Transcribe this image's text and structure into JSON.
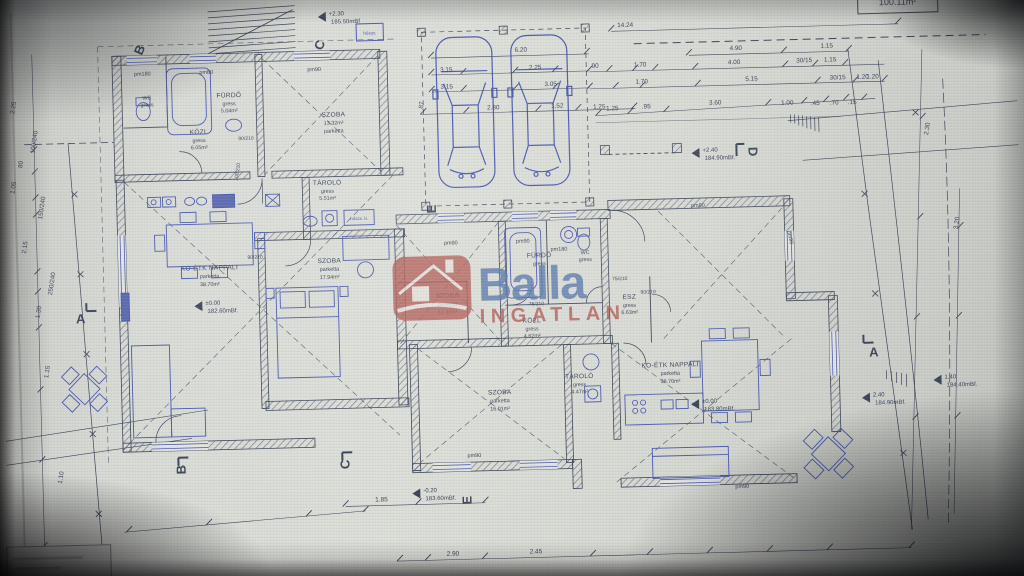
{
  "colors": {
    "ink": "#2e3a55",
    "furniture_blue": "#3b4ec4",
    "logo_blue": "#4a74b8",
    "logo_red": "#c2504a",
    "paper": "#d8dad5"
  },
  "logo": {
    "name": "Balla",
    "tagline": "INGATLAN",
    "icon": "house-icon"
  },
  "area_box": {
    "value": "100.11m²"
  },
  "rooms": [
    {
      "lines": [
        "WC",
        "gress",
        ""
      ]
    },
    {
      "lines": [
        "FÜRDŐ",
        "gress",
        "5.04m²"
      ]
    },
    {
      "lines": [
        "SZOBA",
        "13.32m²",
        "parketta"
      ]
    },
    {
      "lines": [
        "KÖZL",
        "gress",
        "6.05m²"
      ]
    },
    {
      "lines": [
        "TÁROLÓ",
        "gress",
        "5.51m²"
      ]
    },
    {
      "lines": [
        "KO-ÉTK NAPPALI",
        "parketta",
        "38.70m²"
      ]
    },
    {
      "lines": [
        "SZOBA",
        "parketta",
        "17.94m²"
      ]
    },
    {
      "lines": [
        "SZOBA",
        "parketta",
        "12.30m²"
      ]
    },
    {
      "lines": [
        "FÜRDŐ",
        "gress",
        ""
      ]
    },
    {
      "lines": [
        "WC",
        "gress",
        ""
      ]
    },
    {
      "lines": [
        "ESZ",
        "gress",
        "6.63m²"
      ]
    },
    {
      "lines": [
        "KÖZL",
        "gress",
        "4.62m²"
      ]
    },
    {
      "lines": [
        "SZOBA",
        "parketta",
        "16.01m²"
      ]
    },
    {
      "lines": [
        "TÁROLÓ",
        "gress",
        "4.47m²"
      ]
    },
    {
      "lines": [
        "KO-ÉTK NAPPALI",
        "parketta",
        "38.70m²"
      ]
    }
  ],
  "elevations": [
    {
      "v": "+2.30",
      "m": "185.50mBf"
    },
    {
      "v": "+2.40",
      "m": "184.90mBf."
    },
    {
      "v": "±0.00",
      "m": "182.60mBf."
    },
    {
      "v": "±0.00",
      "m": "183.80mBf."
    },
    {
      "v": "-0.20",
      "m": "183.60mBf."
    },
    {
      "v": "1.40",
      "m": "184.40mBf."
    },
    {
      "v": "2.40",
      "m": "184.90mBf."
    }
  ],
  "markers": {
    "b_top": "B",
    "c_top": "C",
    "c_bottom": "C",
    "b_bottom": "B",
    "a_left": "A",
    "a_right": "A",
    "d_right": "D",
    "e_left": "E",
    "e_bottom": "E"
  },
  "pm_labels": [
    "pm180",
    "pm80",
    "pm90",
    "pm90",
    "pm90",
    "pm180",
    "pm90",
    "pm90",
    "pm90",
    "pm90"
  ],
  "door_labels": [
    "90/210",
    "100/210",
    "90/210",
    "75/210",
    "90/210",
    "75/210"
  ],
  "equipment": {
    "heatpump_top": "hőszv.",
    "heatpump_storage": "hőszv. b."
  },
  "dims_top": [
    "14.24",
    "6.20",
    "3.15",
    "2.25",
    "3.15",
    "3.05",
    "2.80",
    "1.52",
    "1.25",
    ".87"
  ],
  "dims_topright": [
    "4.90",
    "1.15",
    ".90",
    "1.70",
    "4.00",
    "30/15",
    "1.15",
    "1.70",
    "5.15",
    "30/15",
    "1.20"
  ],
  "dims_slope": [
    "1.25",
    ".95",
    "3.60",
    "1.00",
    ".45",
    ".70",
    ".15"
  ],
  "dims_left": [
    "2.25",
    "100/240",
    "80",
    "1.05",
    "150/240",
    "2.15",
    "250/240",
    "1.30",
    "1.15",
    "1.10"
  ],
  "dims_bottom": [
    "1.85",
    "2.90",
    "2.45"
  ],
  "dims_right": [
    "1.20",
    "2.30",
    "3.20"
  ]
}
